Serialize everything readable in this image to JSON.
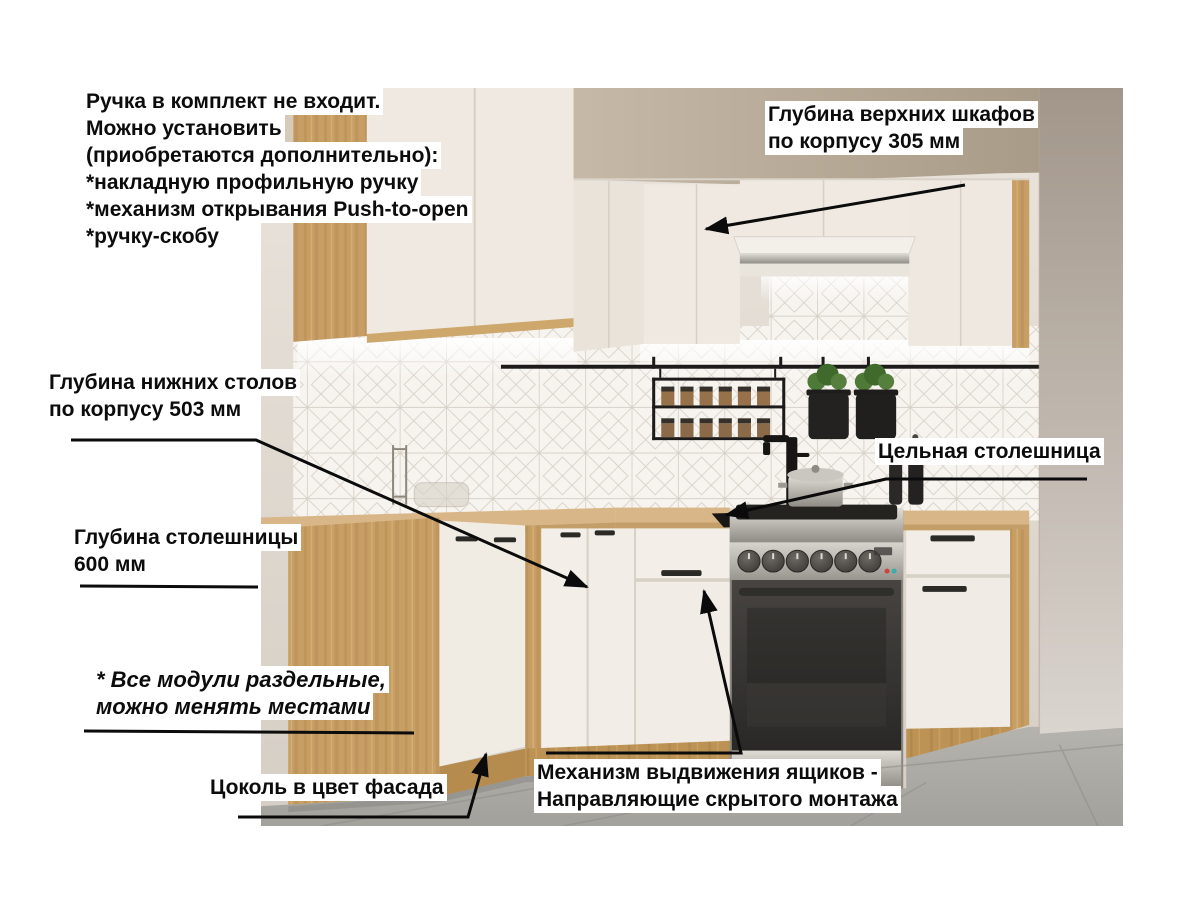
{
  "annotations": {
    "handle_note": {
      "lines": [
        "Ручка в комплект не входит.",
        "Можно установить",
        "(приобретаются дополнительно):",
        "*накладную профильную ручку",
        "*механизм открывания Push-to-open",
        "*ручку-скобу"
      ]
    },
    "upper_cabinet_depth": {
      "lines": [
        "Глубина верхних шкафов",
        "по корпусу 305 мм"
      ]
    },
    "base_cabinet_depth": {
      "lines": [
        "Глубина нижних столов",
        "по корпусу 503 мм"
      ]
    },
    "countertop_depth": {
      "lines": [
        "Глубина столешницы",
        " 600 мм"
      ]
    },
    "solid_countertop": {
      "label": "Цельная столешница"
    },
    "modules_note": {
      "lines": [
        "* Все модули раздельные,",
        "можно менять местами"
      ]
    },
    "plinth_note": {
      "label": "Цоколь в цвет фасада"
    },
    "drawer_mechanism": {
      "lines": [
        "Механизм выдвижения ящиков -",
        "Направляющие скрытого монтажа"
      ]
    }
  },
  "colors": {
    "annotation_text": "#0c0c0c",
    "annotation_line": "#0b0b0b",
    "label_background": "#ffffff",
    "cabinet_front_white": "#efe9e1",
    "wood_oak": "#c79e64",
    "countertop_wood": "#d8b687",
    "ceiling_tan": "#b2a38f",
    "wall_gray": "#ddd6cc",
    "backsplash_tile": "#f7f4ef",
    "floor_tile": "#b3b1ac",
    "accent_black": "#1c1b19",
    "stove_steel": "#b0ada6",
    "oven_black": "#3a3835",
    "plant_green": "#4d7a37"
  }
}
